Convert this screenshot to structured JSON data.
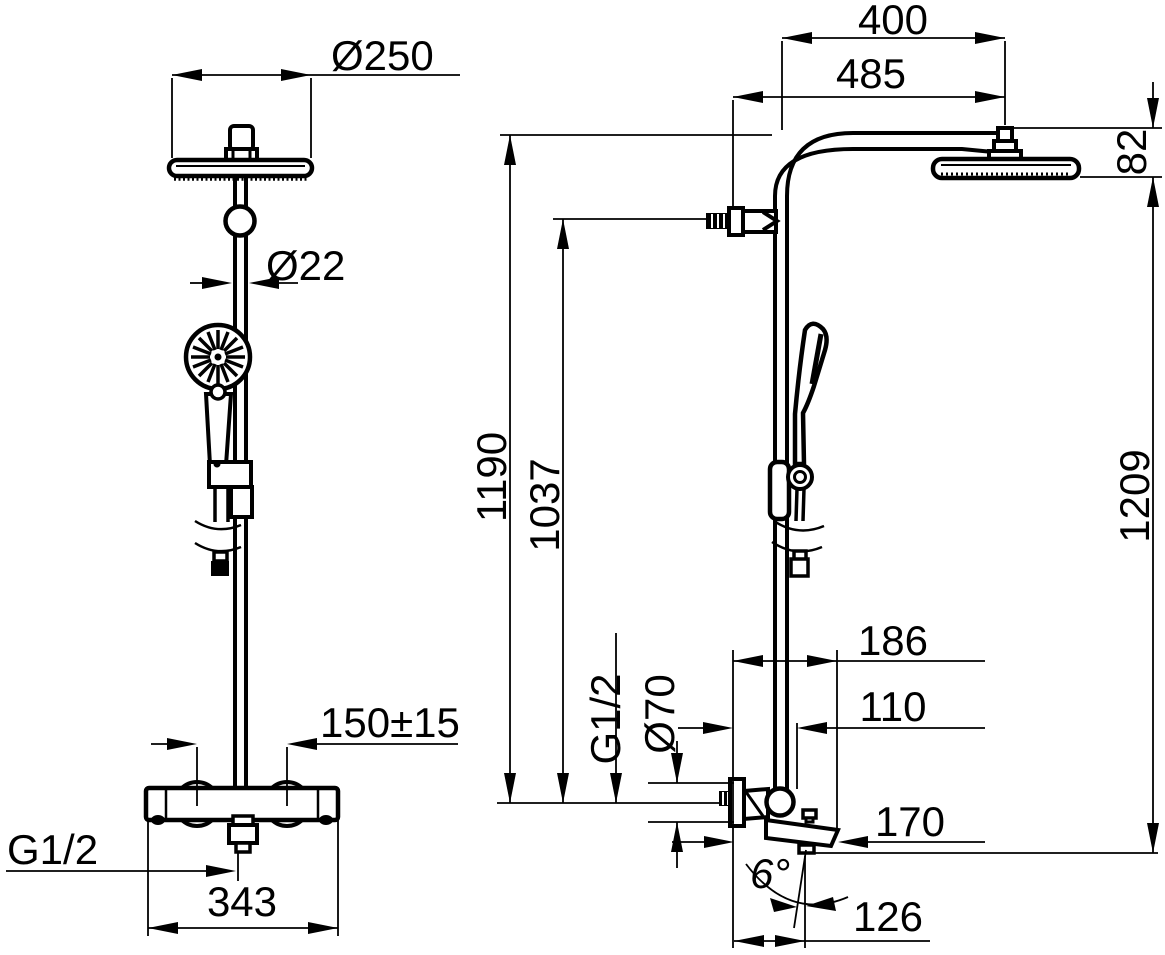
{
  "title": "Shower system dimensional drawing",
  "colors": {
    "background": "#ffffff",
    "line": "#000000"
  },
  "front_view": {
    "head_diameter": "Ø250",
    "pipe_diameter": "Ø22",
    "inlet_spacing": "150±15",
    "outlet_thread": "G1/2",
    "body_width": "343"
  },
  "side_view": {
    "arm_projection": "400",
    "arm_projection_total": "485",
    "head_drop": "82",
    "height_to_arm": "1190",
    "height_to_inlet": "1037",
    "height_total": "1209",
    "spout_depth_top": "186",
    "spout_depth_mid": "110",
    "inlet_thread": "G1/2",
    "escutcheon_diameter": "Ø70",
    "spout_reach": "170",
    "spout_angle": "6°",
    "outlet_offset": "126"
  }
}
